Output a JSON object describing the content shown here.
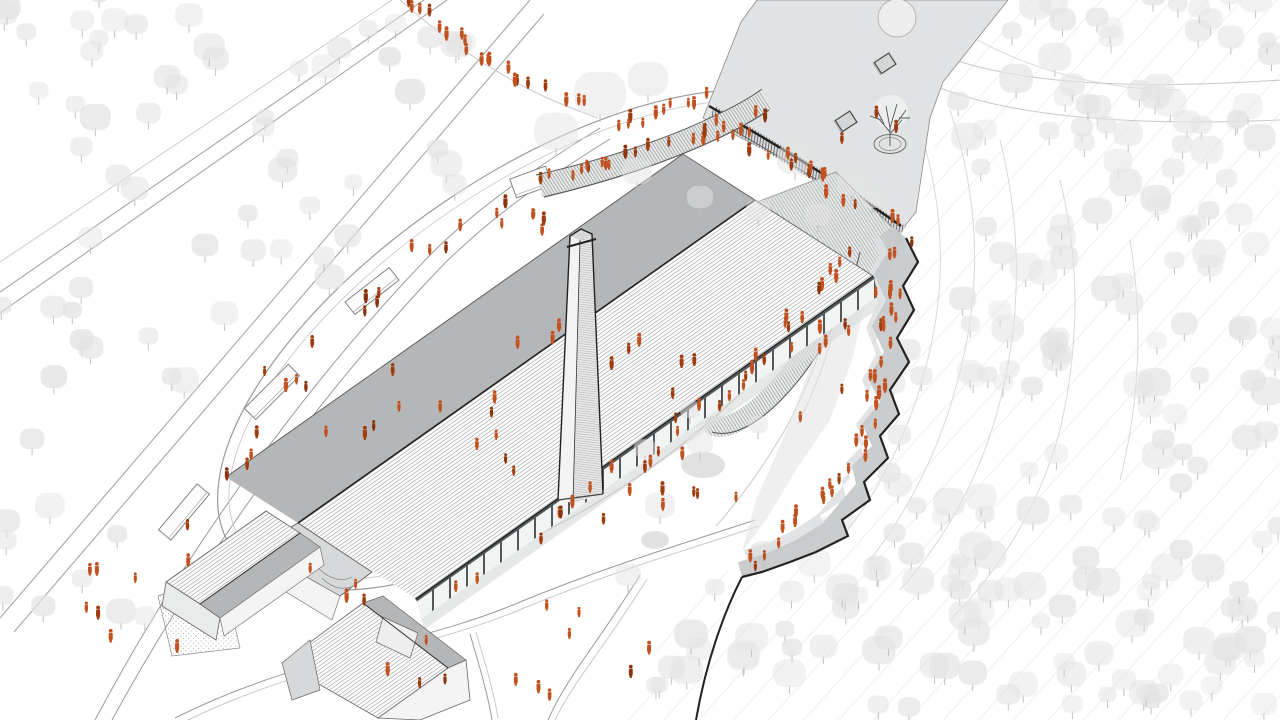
{
  "meta": {
    "title": "Aerial architectural site illustration",
    "caption": "Hand-drawn style aerial axonometric of a long industrial hall with brick chimney, curved promenade and plaza, hillside terraces and forest, populated with small orange figures"
  },
  "canvas": {
    "width": 1280,
    "height": 720
  },
  "colors": {
    "background": "#ffffff",
    "ink": "#222222",
    "line_mid": "#555555",
    "line_soft": "#9a9a9a",
    "road": "#a6a6a6",
    "hatch": "#8f9496",
    "facade_hatch": "#5f6365",
    "roof_shade": "#b4b6b8",
    "roof_end": "#d6d8d9",
    "wall_light": "#f4f4f4",
    "plaza": "#e0e2e3",
    "plaza_feature": "#d0d2d3",
    "terrace": "#c6c8c9",
    "terrace_light": "#dcdee0",
    "terrace_wedge": "#e4e5e6",
    "lawn": "#d9dadb",
    "tree_fill": "#e3e3e3",
    "tree_stem": "#c2c2c2",
    "contour": "#d8d8d8",
    "streak": "#e6e6e6",
    "chimney_face": "#f3f3f3",
    "chimney_side": "#e9e9e9",
    "stipple": "#bdbdbd",
    "person_main": "#c1521f",
    "person_dark": "#9e3c0e",
    "person_deep": "#8a3209"
  },
  "people": {
    "glyph": "standing-figure",
    "palette_weights": [
      [
        "person_main",
        0.68
      ],
      [
        "person_dark",
        0.22
      ],
      [
        "person_deep",
        0.1
      ]
    ],
    "lines": [
      [
        408,
        2,
        520,
        82,
        14,
        7,
        11
      ],
      [
        520,
        82,
        592,
        110,
        6,
        6,
        12
      ],
      [
        548,
        183,
        764,
        120,
        22,
        9,
        13
      ],
      [
        620,
        128,
        702,
        99,
        10,
        8,
        14
      ],
      [
        718,
        124,
        896,
        226,
        12,
        9,
        15
      ],
      [
        903,
        244,
        861,
        462,
        24,
        10,
        16
      ],
      [
        858,
        466,
        754,
        564,
        13,
        8,
        17
      ],
      [
        848,
        254,
        720,
        408,
        13,
        8,
        18
      ],
      [
        232,
        478,
        420,
        258,
        11,
        15,
        19
      ],
      [
        426,
        254,
        518,
        201,
        5,
        9,
        20
      ],
      [
        458,
        596,
        856,
        303,
        15,
        21,
        21
      ]
    ],
    "ellipses": [
      [
        582,
        430,
        150,
        105,
        22,
        31
      ],
      [
        520,
        655,
        148,
        52,
        12,
        32
      ],
      [
        165,
        590,
        92,
        66,
        9,
        33
      ],
      [
        340,
        585,
        42,
        26,
        4,
        34
      ],
      [
        862,
        128,
        48,
        38,
        3,
        35
      ],
      [
        800,
        352,
        52,
        72,
        8,
        36
      ],
      [
        352,
        380,
        88,
        66,
        8,
        37
      ],
      [
        802,
        182,
        38,
        24,
        6,
        38
      ],
      [
        522,
        226,
        26,
        16,
        5,
        39
      ],
      [
        692,
        480,
        58,
        38,
        6,
        40
      ]
    ]
  },
  "trees": {
    "patches": [
      {
        "poly": [
          [
            0,
            0
          ],
          [
            430,
            0
          ],
          [
            560,
            120
          ],
          [
            120,
            450
          ],
          [
            0,
            450
          ]
        ],
        "n": 60,
        "rmin": 9,
        "rmax": 16,
        "seed": 51,
        "omin": 0.45,
        "omax": 0.8
      },
      {
        "poly": [
          [
            0,
            450
          ],
          [
            110,
            450
          ],
          [
            150,
            640
          ],
          [
            60,
            720
          ],
          [
            0,
            720
          ]
        ],
        "n": 10,
        "rmin": 10,
        "rmax": 15,
        "seed": 52,
        "omin": 0.45,
        "omax": 0.8
      },
      {
        "poly": [
          [
            1005,
            0
          ],
          [
            1280,
            0
          ],
          [
            1280,
            720
          ],
          [
            615,
            720
          ],
          [
            700,
            575
          ],
          [
            798,
            558
          ],
          [
            862,
            480
          ],
          [
            898,
            368
          ],
          [
            915,
            240
          ],
          [
            945,
            95
          ]
        ],
        "n": 215,
        "rmin": 9,
        "rmax": 17,
        "seed": 53,
        "omin": 0.4,
        "omax": 0.75
      }
    ],
    "singles": [
      [
        600,
        118,
        26
      ],
      [
        556,
        152,
        22
      ],
      [
        648,
        98,
        20
      ],
      [
        637,
        186,
        15
      ],
      [
        795,
        176,
        18
      ],
      [
        852,
        198,
        15
      ],
      [
        700,
        210,
        13
      ],
      [
        758,
        222,
        12
      ],
      [
        660,
        520,
        15
      ],
      [
        700,
        456,
        13
      ],
      [
        628,
        588,
        13
      ],
      [
        758,
        435,
        10
      ],
      [
        818,
        228,
        13
      ],
      [
        872,
        210,
        11
      ],
      [
        690,
        420,
        10
      ],
      [
        645,
        460,
        11
      ]
    ]
  },
  "lawn_patches": [
    [
      703,
      465,
      22,
      13
    ],
    [
      655,
      540,
      14,
      9
    ]
  ],
  "platforms": [
    [
      184,
      512,
      60,
      16,
      -50
    ],
    [
      272,
      392,
      62,
      16,
      -45
    ],
    [
      372,
      291,
      56,
      16,
      -38
    ],
    [
      531,
      182,
      38,
      20,
      -20
    ]
  ]
}
